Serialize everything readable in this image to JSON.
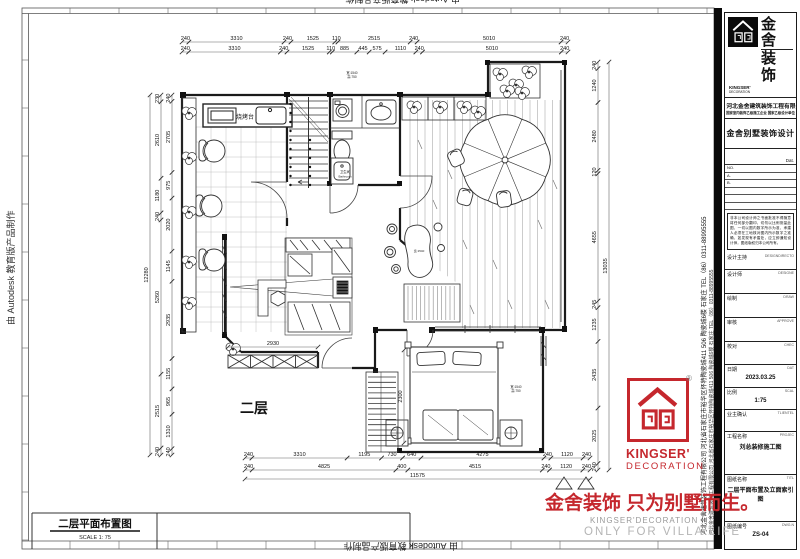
{
  "sheet": {
    "autodesk_credit": "由 Autodesk 教育版产品制作",
    "floor_label": "二层",
    "drawing_title": "二层平面布置图",
    "drawing_scale": "SCALE 1: 75"
  },
  "plan_labels": {
    "bbq_counter": "烧烤台",
    "bathroom_tag_line1": "卫生间",
    "bathroom_tag_line2": "Bathroom",
    "window_tag_line1": "宽:1540",
    "window_tag_line2": "高:750"
  },
  "dimensions": {
    "top_row1": [
      "240",
      "3310",
      "240",
      "1525",
      "110",
      "2515",
      "240",
      "5010",
      "240"
    ],
    "top_row2": [
      "240",
      "3310",
      "240",
      "1525",
      "110",
      "885",
      "445",
      "575",
      "1110",
      "240",
      "5010",
      "240"
    ],
    "bottom_row1": [
      "240",
      "3310",
      "1195",
      "730",
      "640",
      "4275",
      "240",
      "1120",
      "240"
    ],
    "bottom_row2": [
      "240",
      "4825",
      "400",
      "4515",
      "240",
      "1120",
      "240"
    ],
    "bottom_total": [
      "11575"
    ],
    "left_total": [
      "12280"
    ],
    "left_col_mid": [
      "230",
      "2610",
      "1180",
      "240",
      "5260",
      "2515",
      "240"
    ],
    "left_col_inner": [
      "240",
      "2705",
      "975",
      "2020",
      "1145",
      "2935",
      "1155",
      "965",
      "1310",
      "240"
    ],
    "right_col": [
      "240",
      "1240",
      "2480",
      "120",
      "4655",
      "245",
      "1235",
      "2435",
      "2025",
      "240"
    ],
    "right_total": [
      "13035"
    ],
    "living_width": [
      "2930"
    ],
    "bed_depth": [
      "2300"
    ]
  },
  "title_block": {
    "company": "河北金舍建筑装饰工程有限公司",
    "company_en": "He Bei Jin She Building Decoration Engineering Co., Ltd",
    "qualification": "国家室内装饰乙级施工企业 国家乙级设计单位",
    "product": "金舍别墅装饰设计",
    "date_label": "Dat.",
    "no_label": "NO.",
    "a_label": "A.",
    "b_label": "B.",
    "notice": "非本公司设计师之书面批准不得随意将任何部分翻印，切勿以比例测量此图，一切以图内数字所示为准，承建人必须在工地核对图内所示数字之准确，如发现有矛盾处，应立即通知设计师，图纸版权归本公司所有。",
    "rows": [
      {
        "cn": "设计主持",
        "en": "DESIGNDIRECTO",
        "value": ""
      },
      {
        "cn": "设计师",
        "en": "DESIGNE",
        "value": ""
      },
      {
        "cn": "绘制",
        "en": "DRAW",
        "value": ""
      },
      {
        "cn": "审核",
        "en": "APPROVE",
        "value": ""
      },
      {
        "cn": "校对",
        "en": "CHEC",
        "value": ""
      },
      {
        "cn": "日期",
        "en": "DAT",
        "value": "2023.03.25"
      },
      {
        "cn": "比例",
        "en": "SCAL",
        "value": "1:75"
      },
      {
        "cn": "业主确认",
        "en": "TLIENTEL",
        "value": ""
      },
      {
        "cn": "工程名称",
        "en": "PROJEC",
        "value": "刘总装修施工图"
      },
      {
        "cn": "图纸名称",
        "en": "TITL",
        "value": "二层平面布置及立面索引图"
      },
      {
        "cn": "图纸编号",
        "en": "DWG.N",
        "value": "ZS-04"
      }
    ]
  },
  "branding": {
    "logo_text_1": "金舍",
    "logo_text_2": "装饰",
    "logo_en_1": "KINGSER'",
    "logo_en_2": "DECORATION",
    "registered": "®",
    "slogan": "金舍装饰 只为别墅而生。",
    "slogan_en_1": "KINGSER'DECORATION",
    "slogan_en_2": "ONLY FOR VILLA LIFE",
    "red": "#c5272d"
  },
  "side_strip": {
    "text": "河北金舍建筑装饰工程有限公司  河北省石家庄市裕华区怀特陶瓷城411 506 陶瓷城6楼  石家庄  TEL（86）0311-88995555"
  }
}
